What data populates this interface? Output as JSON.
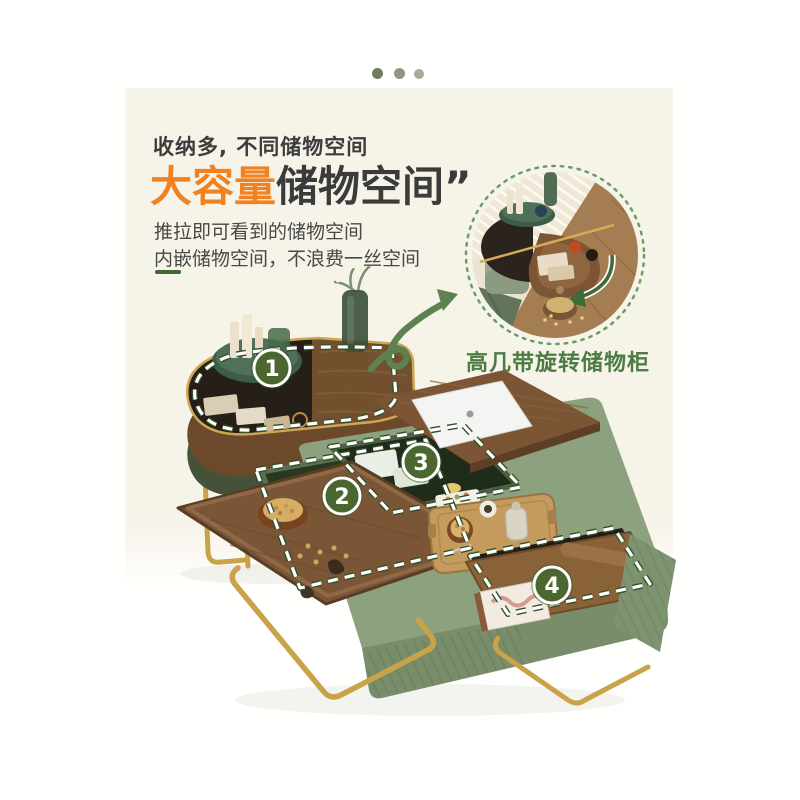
{
  "header": {
    "subtitle": "收纳多, 不同储物空间",
    "title_highlight": "大容量",
    "title_rest": "储物空间",
    "title_quote": "”",
    "desc_line1": "推拉即可看到的储物空间",
    "desc_line2": "内嵌储物空间，不浪费一丝空间"
  },
  "inset": {
    "caption": "高几带旋转储物柜"
  },
  "callouts": {
    "items": [
      {
        "number": "1"
      },
      {
        "number": "2"
      },
      {
        "number": "3"
      },
      {
        "number": "4"
      }
    ]
  },
  "palette": {
    "page_bg": "#fffffd",
    "panel_cream": "#f6f3e9",
    "accent_orange": "#f08222",
    "title_dark": "#3b3b3b",
    "caption_green": "#4d7c43",
    "badge_green": "#4a672f",
    "dash_white": "#ffffff",
    "dash_casing_green": "#33502a",
    "table_sage": "#8ca17e",
    "wood_brown": "#7b5534",
    "frame_gold": "#c9a24a",
    "dot_colors": [
      "#6c7f63",
      "#8a9880",
      "#a3ad97"
    ]
  }
}
